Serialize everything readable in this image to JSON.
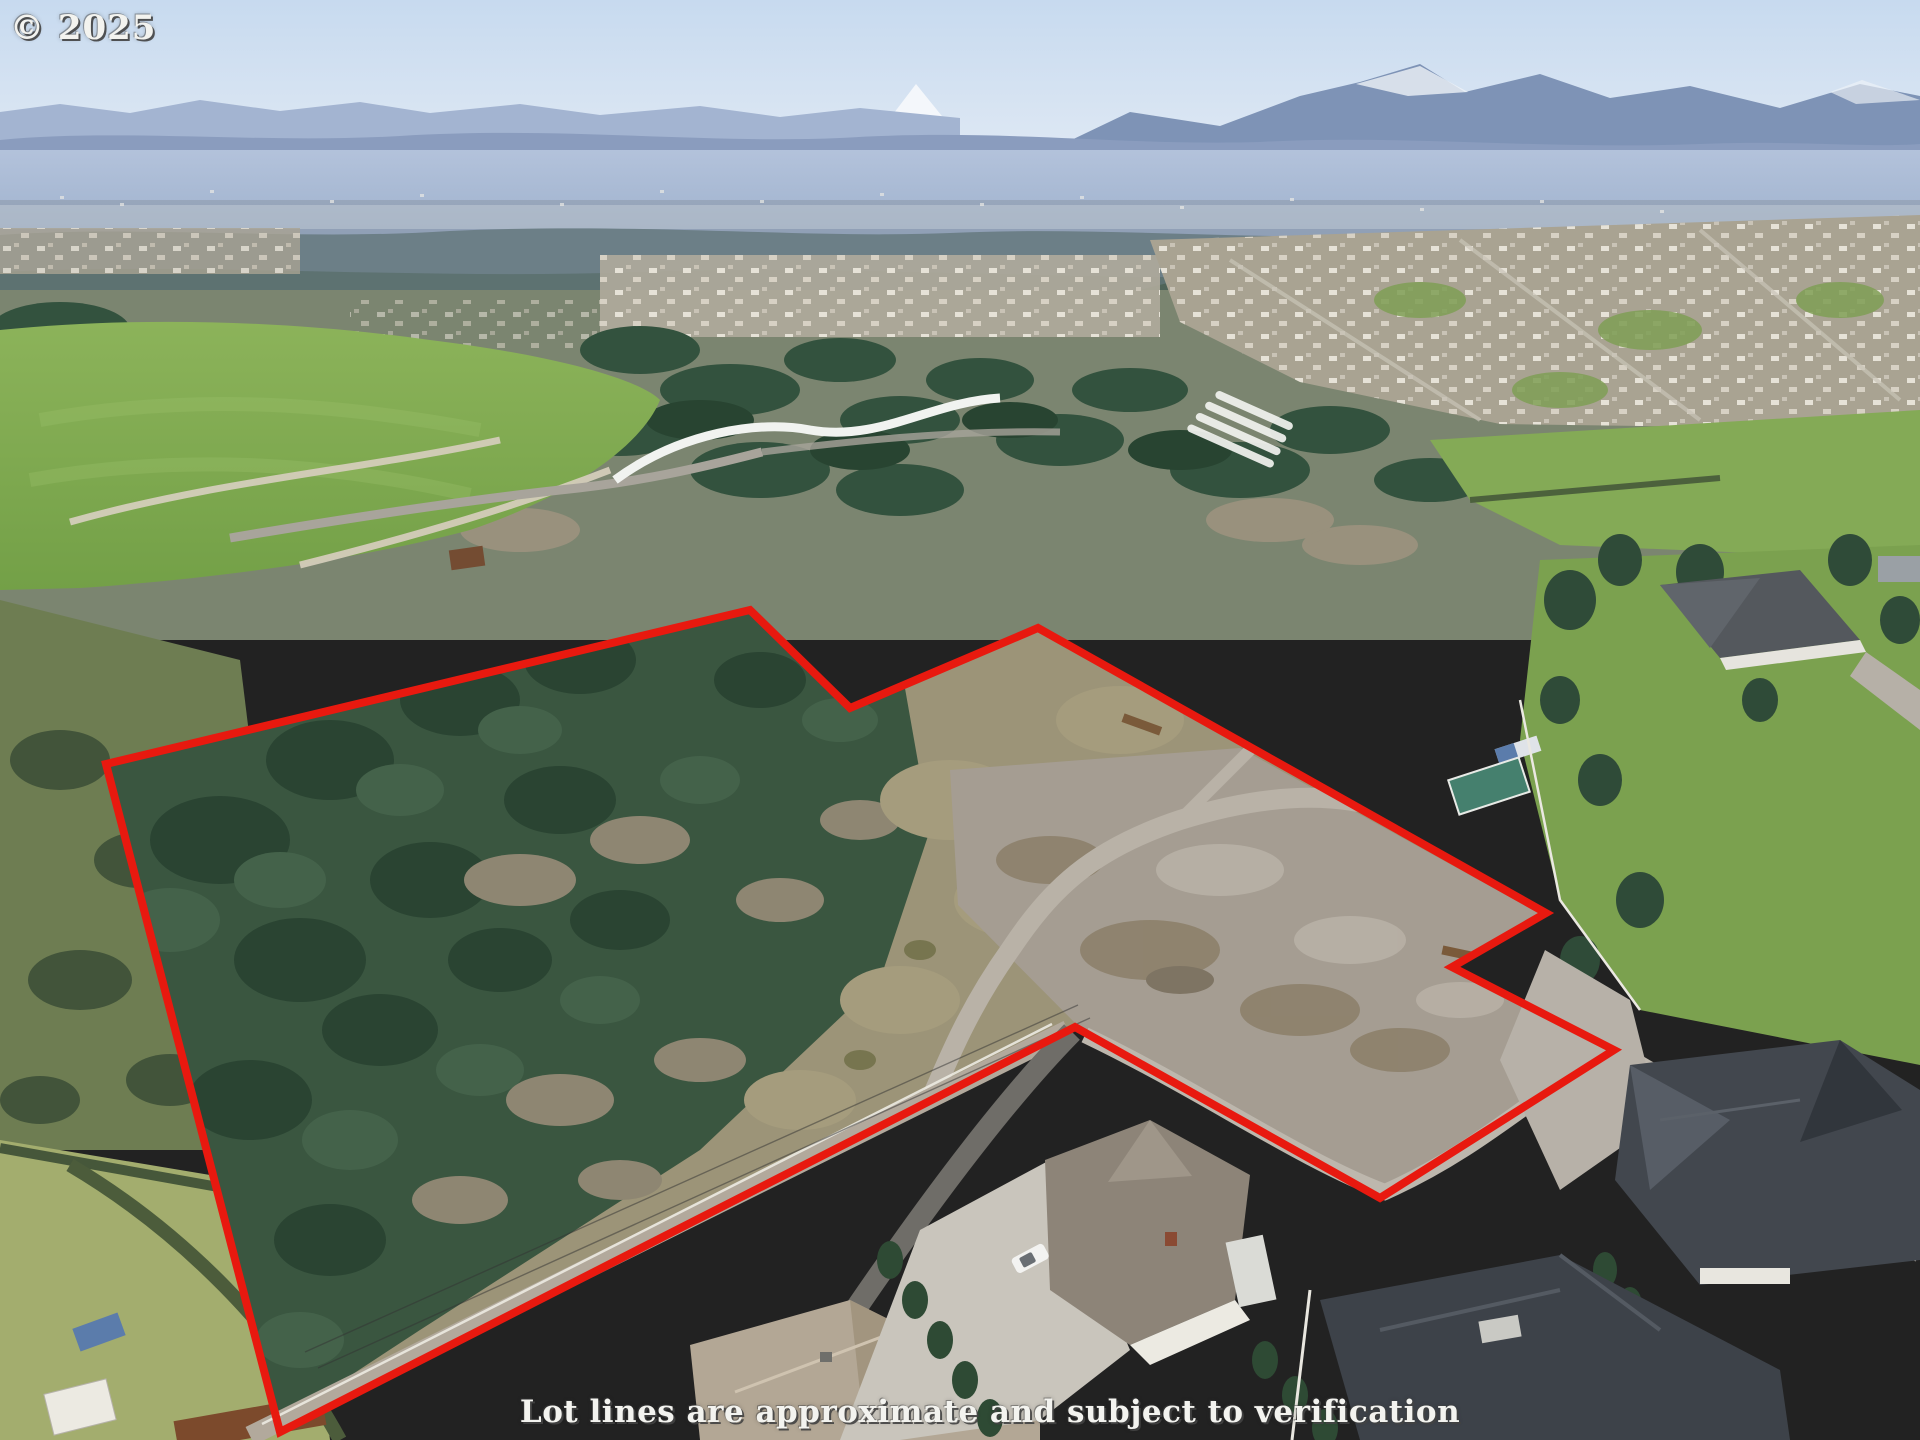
{
  "watermarks": {
    "copyright": "© 2025",
    "disclaimer": "Lot lines are approximate and subject to verification"
  },
  "lot_boundary": {
    "color": "#e8190f",
    "stroke_width": 8,
    "points_attr": "106,764 750,610 850,708 1038,628 1546,913 1452,967 1614,1050 1380,1198 1075,1027 280,1432"
  },
  "scene": {
    "type": "aerial-drone-photo",
    "subject": "vacant treed acreage outlined in red between rural road and new homes",
    "landmarks": {
      "snow_peak_left": "white dome mountain on horizon left",
      "snow_peak_center": "pointed white mountain on horizon center-right",
      "green_park": "mowed green field with curved paths, left middle",
      "white_wall": "serpentine white wall near park",
      "gravel_clearing": "cleared gravel pad in east half of lot",
      "new_homes": "large charcoal-roof houses bottom right"
    }
  },
  "palette": {
    "boundary_red": "#e8190f",
    "watermark_white": "#f3f3ef",
    "sky_top": "#c7daef",
    "sky_horizon": "#e3ebf5",
    "snow": "#f6f8fb",
    "mountain_far": "#a3b4d1",
    "mountain_near": "#7e93b6",
    "valley_haze": "#aebfd8",
    "forest_dark": "#2c4836",
    "forest_mid": "#3c5a44",
    "deciduous_gray": "#99917d",
    "field_green": "#83ab54",
    "brush_tan": "#a29a7c",
    "gravel": "#a8a096",
    "road_asphalt": "#6f6d68",
    "road_gravel": "#b2a99c",
    "roof_charcoal": "#42474e",
    "roof_farmhouse": "#8d8478",
    "roof_tan": "#b3a795",
    "wall_white": "#efeee8"
  }
}
